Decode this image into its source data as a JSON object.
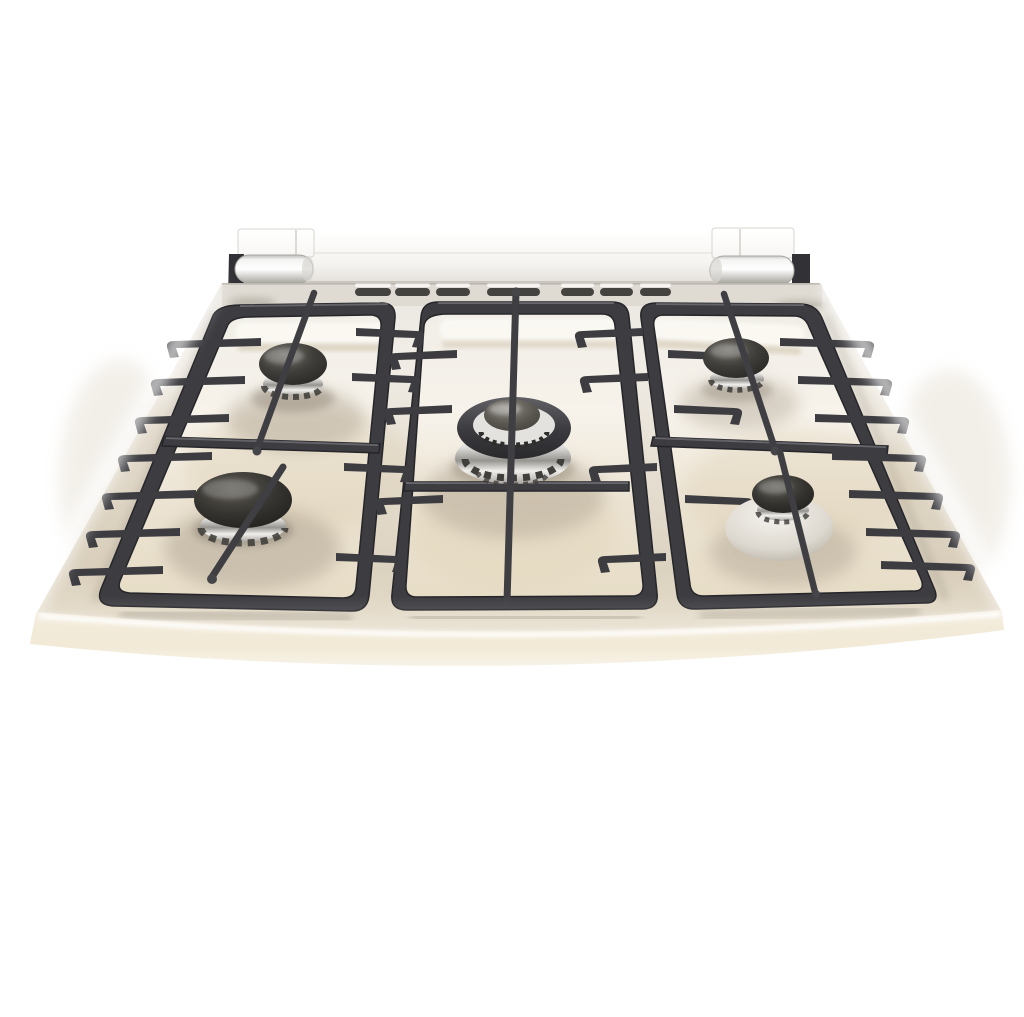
{
  "meta": {
    "description": "Product photo: front view of a stainless steel five-burner gas range cooktop with black cast-iron grates, a row of rear vent slots and two chrome lid hinges, on a plain white background",
    "image_type": "product photograph",
    "background_color": "#ffffff"
  },
  "palette": {
    "steel_light": "#f2efe9",
    "steel_warm": "#d3c3a6",
    "lip_beige": "#ecdfc3",
    "grate_iron": "#3d3d41",
    "grate_shadow": "#27272a",
    "burner_cap_dark": "#2b2927",
    "burner_cap_gray": "#56544f",
    "chrome_light": "#f7f7f6",
    "chrome_shade": "#96948f",
    "reflection_warm": "#b3a796"
  },
  "cooktop": {
    "lid": {
      "label": "folded lid edge",
      "hinges": [
        {
          "label": "left lid hinge"
        },
        {
          "label": "right lid hinge"
        }
      ]
    },
    "vent_row": {
      "slot_count": 7
    },
    "grates": [
      {
        "label": "left grate section"
      },
      {
        "label": "center grate section"
      },
      {
        "label": "right grate section"
      }
    ],
    "burners": {
      "count": 5,
      "items": [
        {
          "id": "left-rear",
          "label": "left rear burner",
          "size": "medium"
        },
        {
          "id": "left-front",
          "label": "left front burner",
          "size": "large"
        },
        {
          "id": "center",
          "label": "center wok burner",
          "size": "extra large",
          "detail": "double ring with chrome slotted base"
        },
        {
          "id": "right-rear",
          "label": "right rear burner",
          "size": "medium"
        },
        {
          "id": "right-front",
          "label": "right front burner",
          "size": "small",
          "detail": "chrome bowl base"
        }
      ]
    }
  }
}
